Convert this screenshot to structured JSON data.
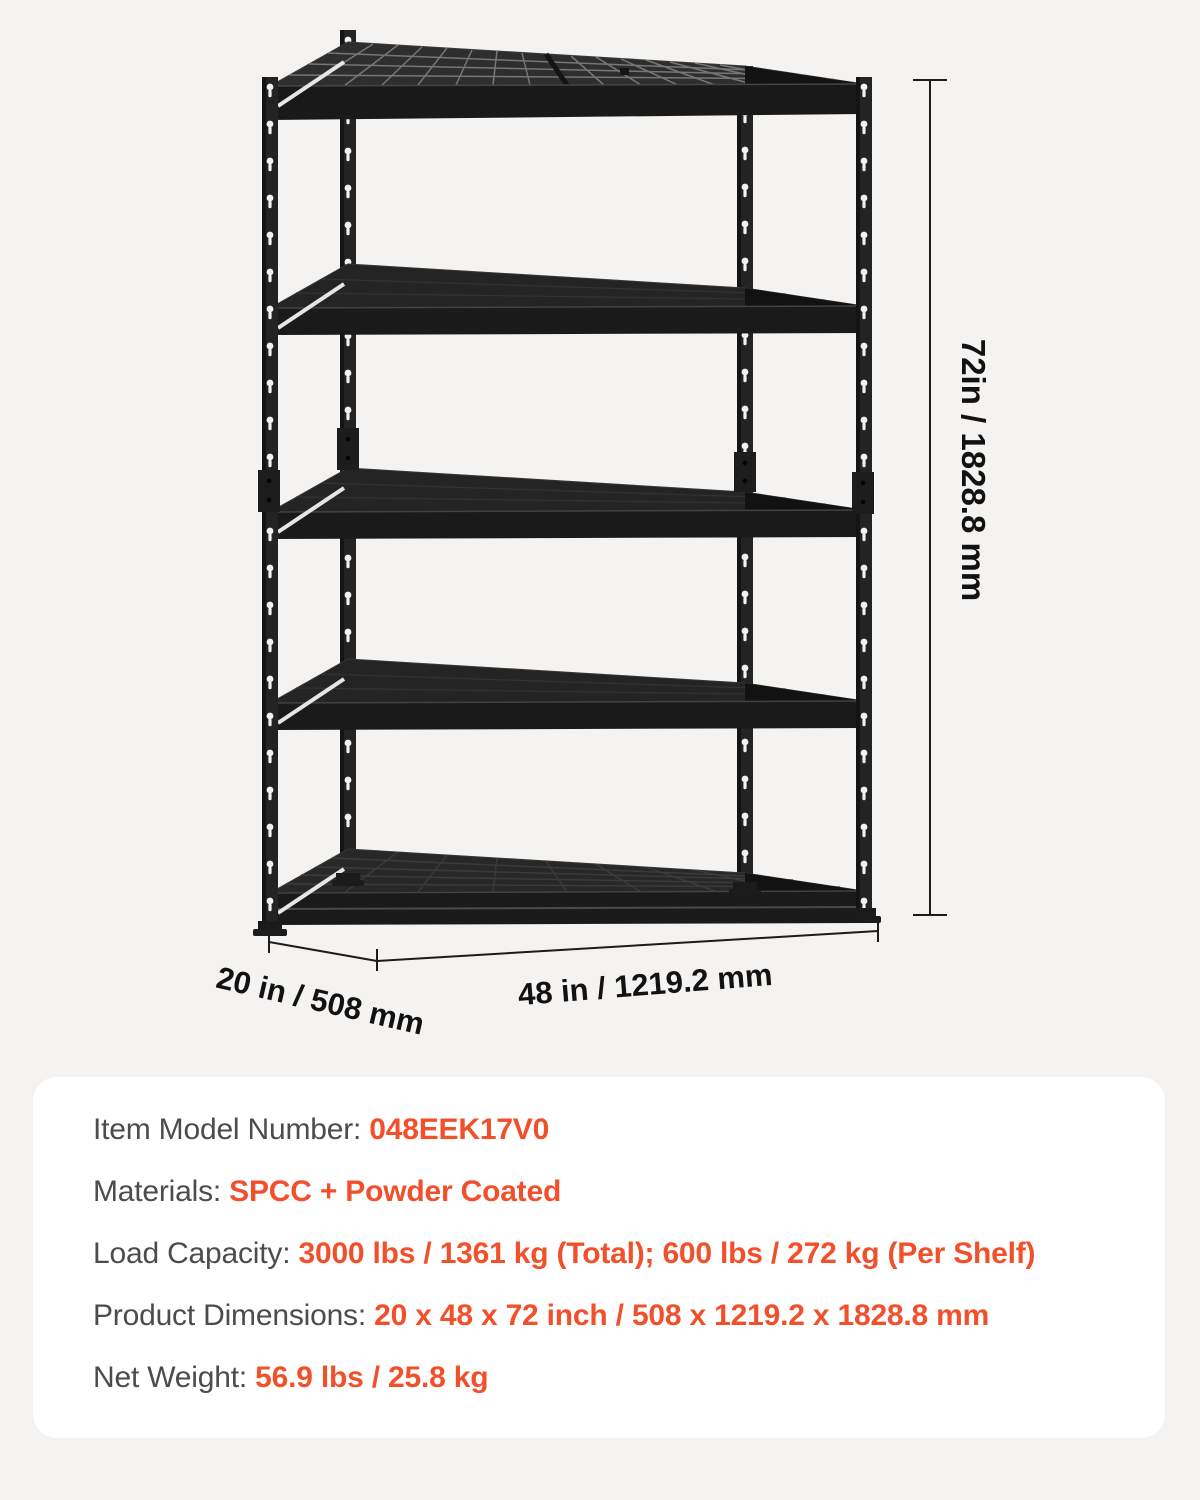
{
  "page": {
    "background_color": "#f4f3f2",
    "panel_color": "#ffffff",
    "accent_color": "#f2502b",
    "label_color": "#4a4c4e",
    "dimension_text_color": "#121212",
    "rack_color": "#232323"
  },
  "diagram": {
    "product": "5-tier metal shelving rack",
    "height_label": "72in / 1828.8 mm",
    "depth_label": "20 in / 508 mm",
    "width_label": "48 in / 1219.2 mm"
  },
  "specs": {
    "rows": [
      {
        "label": "Item Model Number: ",
        "value": "048EEK17V0"
      },
      {
        "label": "Materials: ",
        "value": "SPCC + Powder Coated"
      },
      {
        "label": "Load Capacity: ",
        "value": "3000 lbs / 1361 kg (Total); 600 lbs / 272 kg (Per Shelf)"
      },
      {
        "label": "Product Dimensions: ",
        "value": "20 x 48 x 72 inch / 508 x 1219.2 x 1828.8 mm"
      },
      {
        "label": "Net Weight: ",
        "value": "56.9 lbs / 25.8 kg"
      }
    ]
  }
}
